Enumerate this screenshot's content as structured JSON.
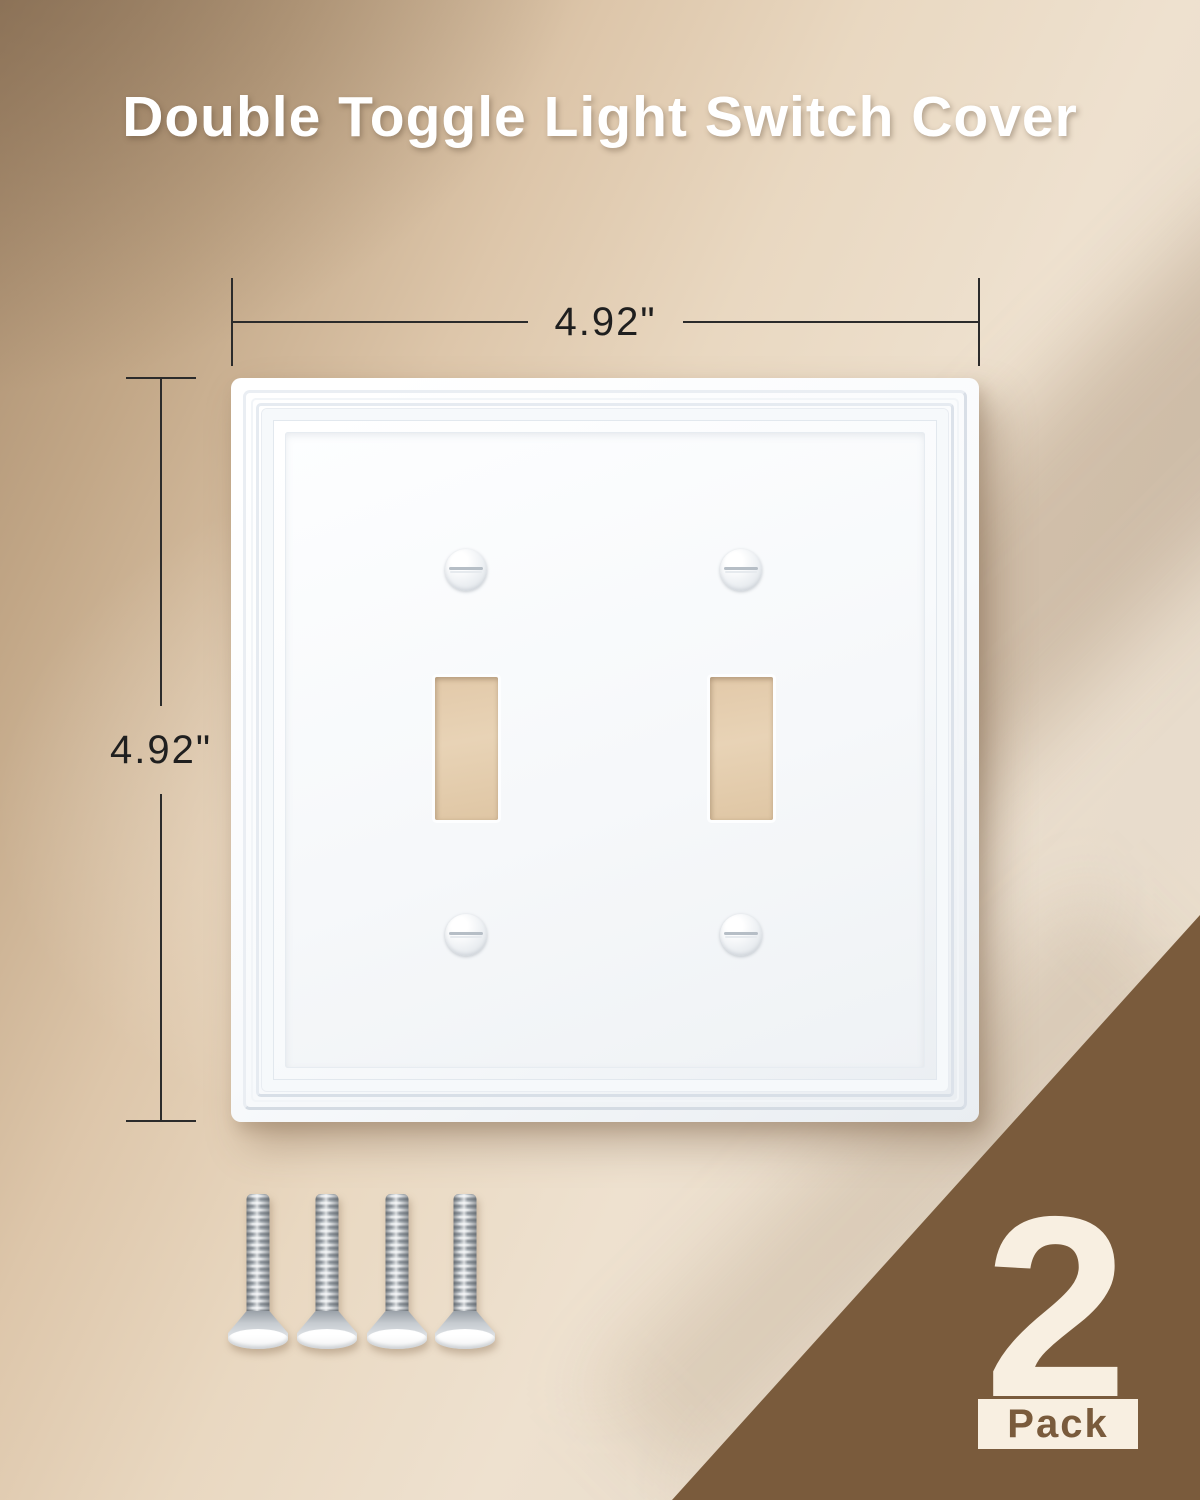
{
  "title": "Double Toggle Light Switch Cover",
  "dimensions": {
    "width_label": "4.92\"",
    "height_label": "4.92\""
  },
  "badge": {
    "count": "2",
    "unit": "Pack"
  },
  "product": {
    "item": "double toggle switch wall plate",
    "toggle_openings": 2,
    "plate_screws": 4,
    "included_mounting_screws": 4
  },
  "colors": {
    "wall_dark": "#a78b6d",
    "wall_light": "#eee1cf",
    "plate_white": "#f8fafc",
    "accent_brown": "#7a5b3c",
    "badge_cream": "#f8efe1",
    "dimension_line": "#2b2b2b",
    "cutout_tan": "#e5ceb0"
  }
}
